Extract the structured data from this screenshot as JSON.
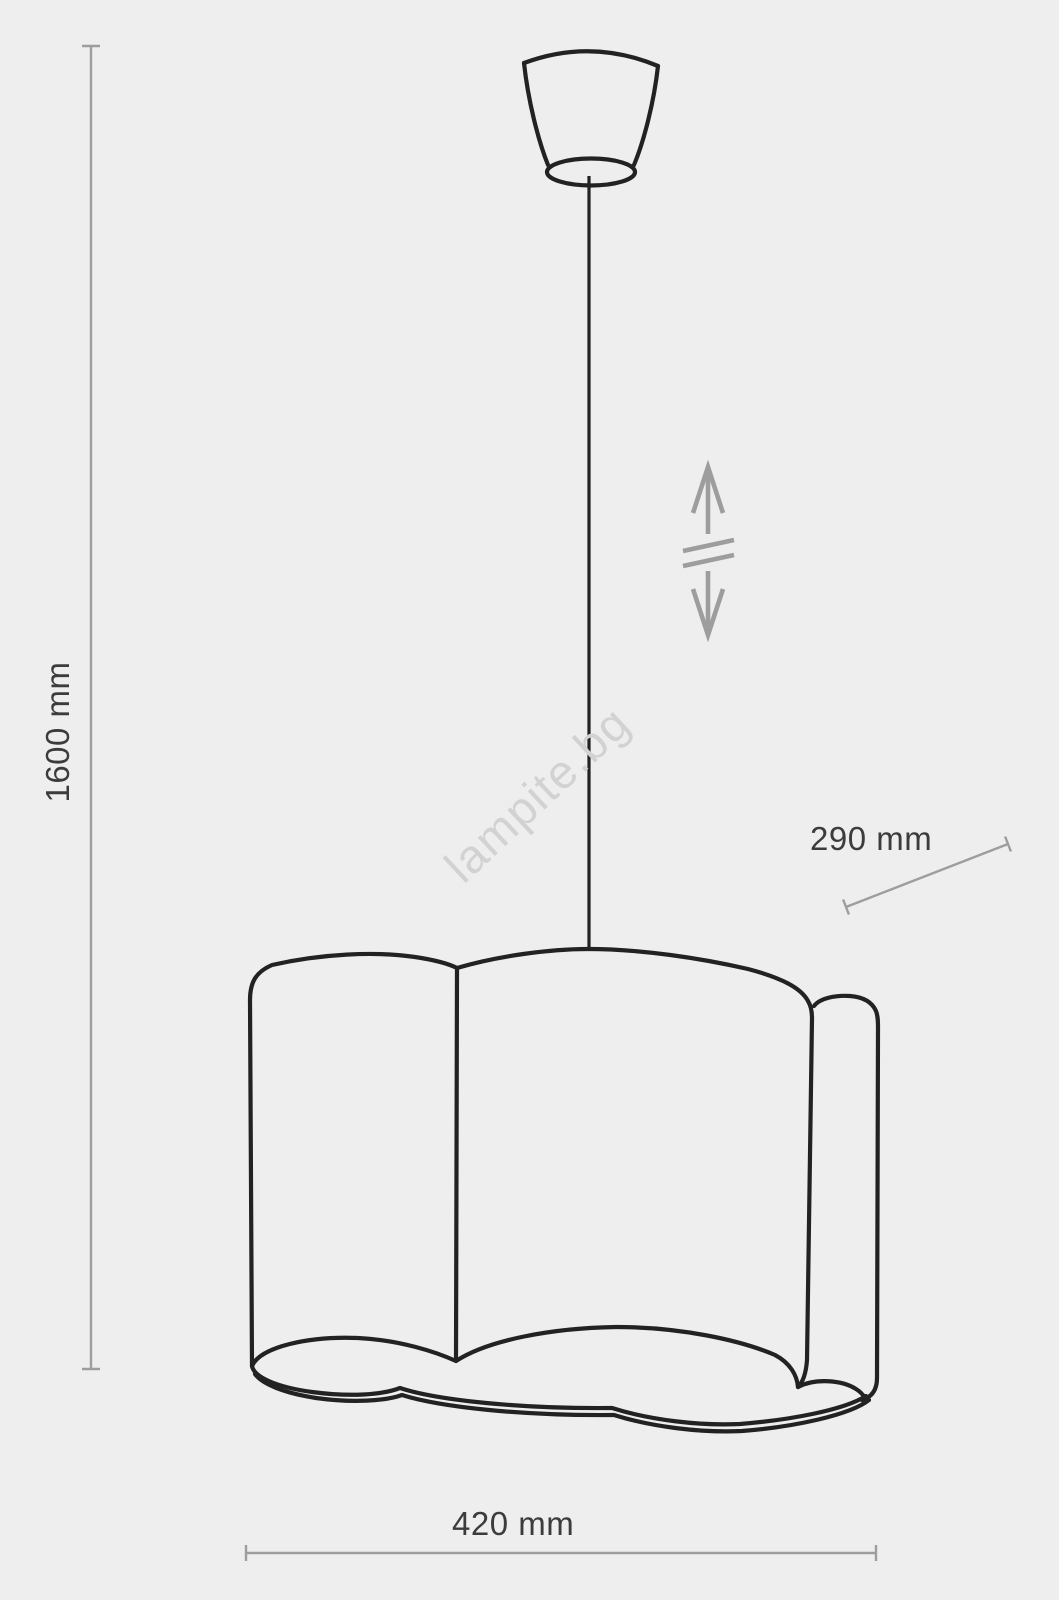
{
  "diagram": {
    "watermark": "lampite.bg",
    "dimensions": {
      "height": "1600 mm",
      "depth": "290 mm",
      "width": "420 mm"
    },
    "icons": {
      "height_adjust": "double-vertical-arrow-with-break",
      "parts": [
        "ceiling-canopy",
        "suspension-cord",
        "cloud-lampshade"
      ]
    }
  },
  "colors": {
    "background": "#eeeeee",
    "outline": "#232222",
    "dim": "#9d9d9d",
    "text": "#3c3c3c",
    "watermark": "#d2d2d2"
  }
}
